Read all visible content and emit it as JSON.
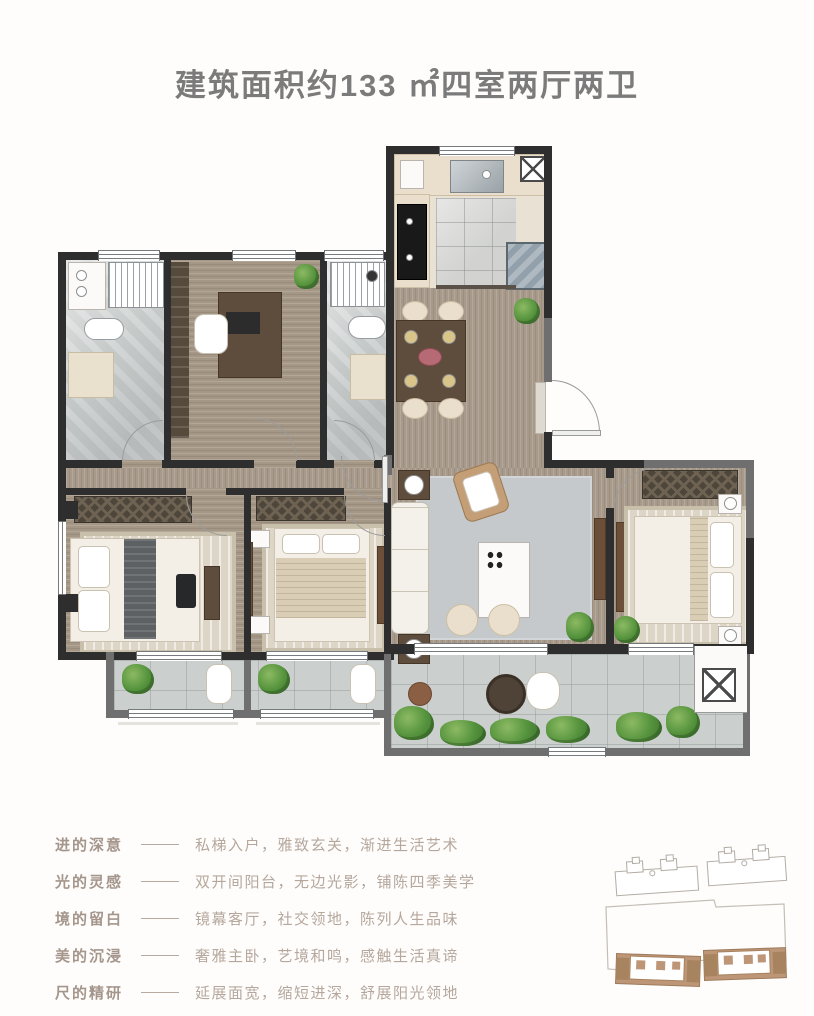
{
  "title": "建筑面积约133 ㎡四室两厅两卫",
  "features": [
    {
      "label": "进的深意",
      "text": "私梯入户，雅致玄关，渐进生活艺术"
    },
    {
      "label": "光的灵感",
      "text": "双开间阳台，无边光影，铺陈四季美学"
    },
    {
      "label": "境的留白",
      "text": "镜幕客厅，社交领地，陈列人生品味"
    },
    {
      "label": "美的沉浸",
      "text": "奢雅主卧，艺境和鸣，感触生活真谛"
    },
    {
      "label": "尺的精研",
      "text": "延展面宽，缩短进深，舒展阳光领地"
    }
  ],
  "colors": {
    "title_text": "#7b7b7b",
    "feature_label": "#a5968c",
    "feature_text": "#b5a79c",
    "wall_dark": "#2e2e2e",
    "wall_light": "#6f6f6f",
    "wood_floor": "#a89a8b",
    "tile_floor": "#cbd0cf",
    "marble_floor": "#c6cac9",
    "accent_wood": "#5e4c3c",
    "highlighted_building": "#bd9577",
    "plant_green": "#54923c"
  }
}
